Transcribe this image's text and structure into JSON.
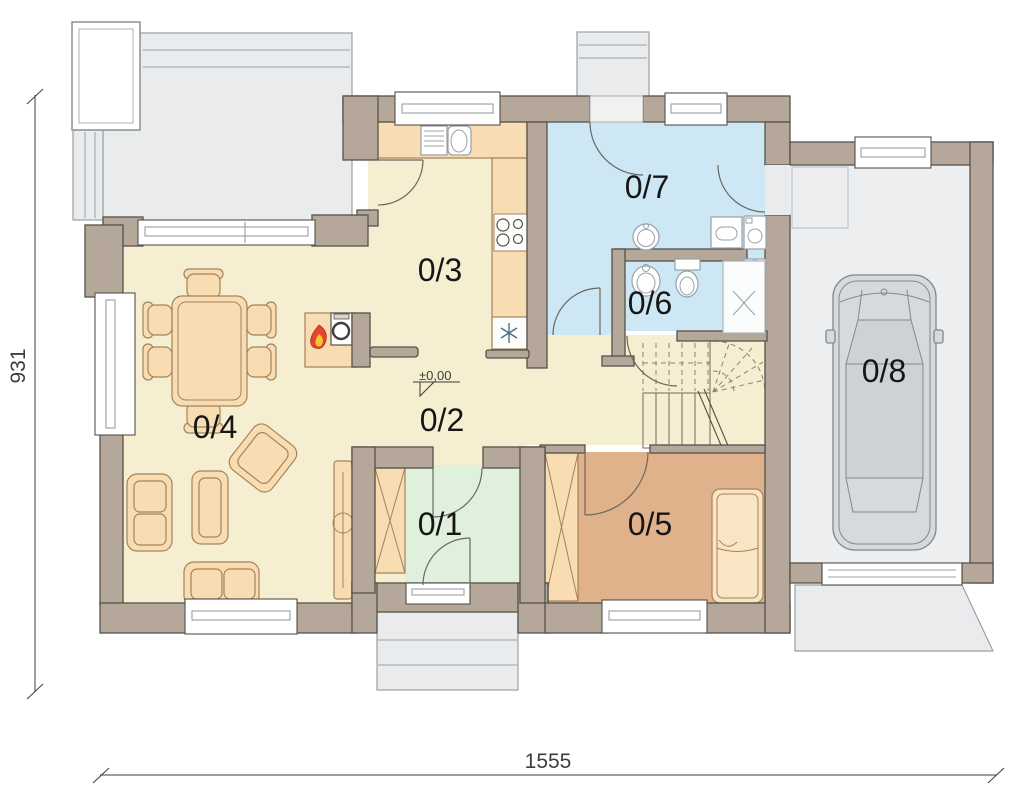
{
  "palette": {
    "wall": "#b5a89a",
    "wall_outline": "#55514a",
    "floor_cream": "#f6eed0",
    "floor_blue": "#cde7f4",
    "floor_green": "#dff0dc",
    "floor_brown": "#dfb28b",
    "floor_garage": "#eceef0",
    "furniture": "#f8dcb2",
    "furniture_outline": "#a5825c",
    "concrete": "#e9ebed",
    "concrete_outline": "#9ba1a5",
    "flame_red": "#e2472e",
    "flame_yellow": "#f8c62e",
    "dim_color": "#3f3e3a",
    "label_color": "#161616"
  },
  "rooms": [
    {
      "label": "0/1"
    },
    {
      "label": "0/2"
    },
    {
      "label": "0/3"
    },
    {
      "label": "0/4"
    },
    {
      "label": "0/5"
    },
    {
      "label": "0/6"
    },
    {
      "label": "0/7"
    },
    {
      "label": "0/8"
    }
  ],
  "dimensions": {
    "width": "1555",
    "height": "931"
  },
  "level_marker": {
    "value": "±0,00"
  }
}
